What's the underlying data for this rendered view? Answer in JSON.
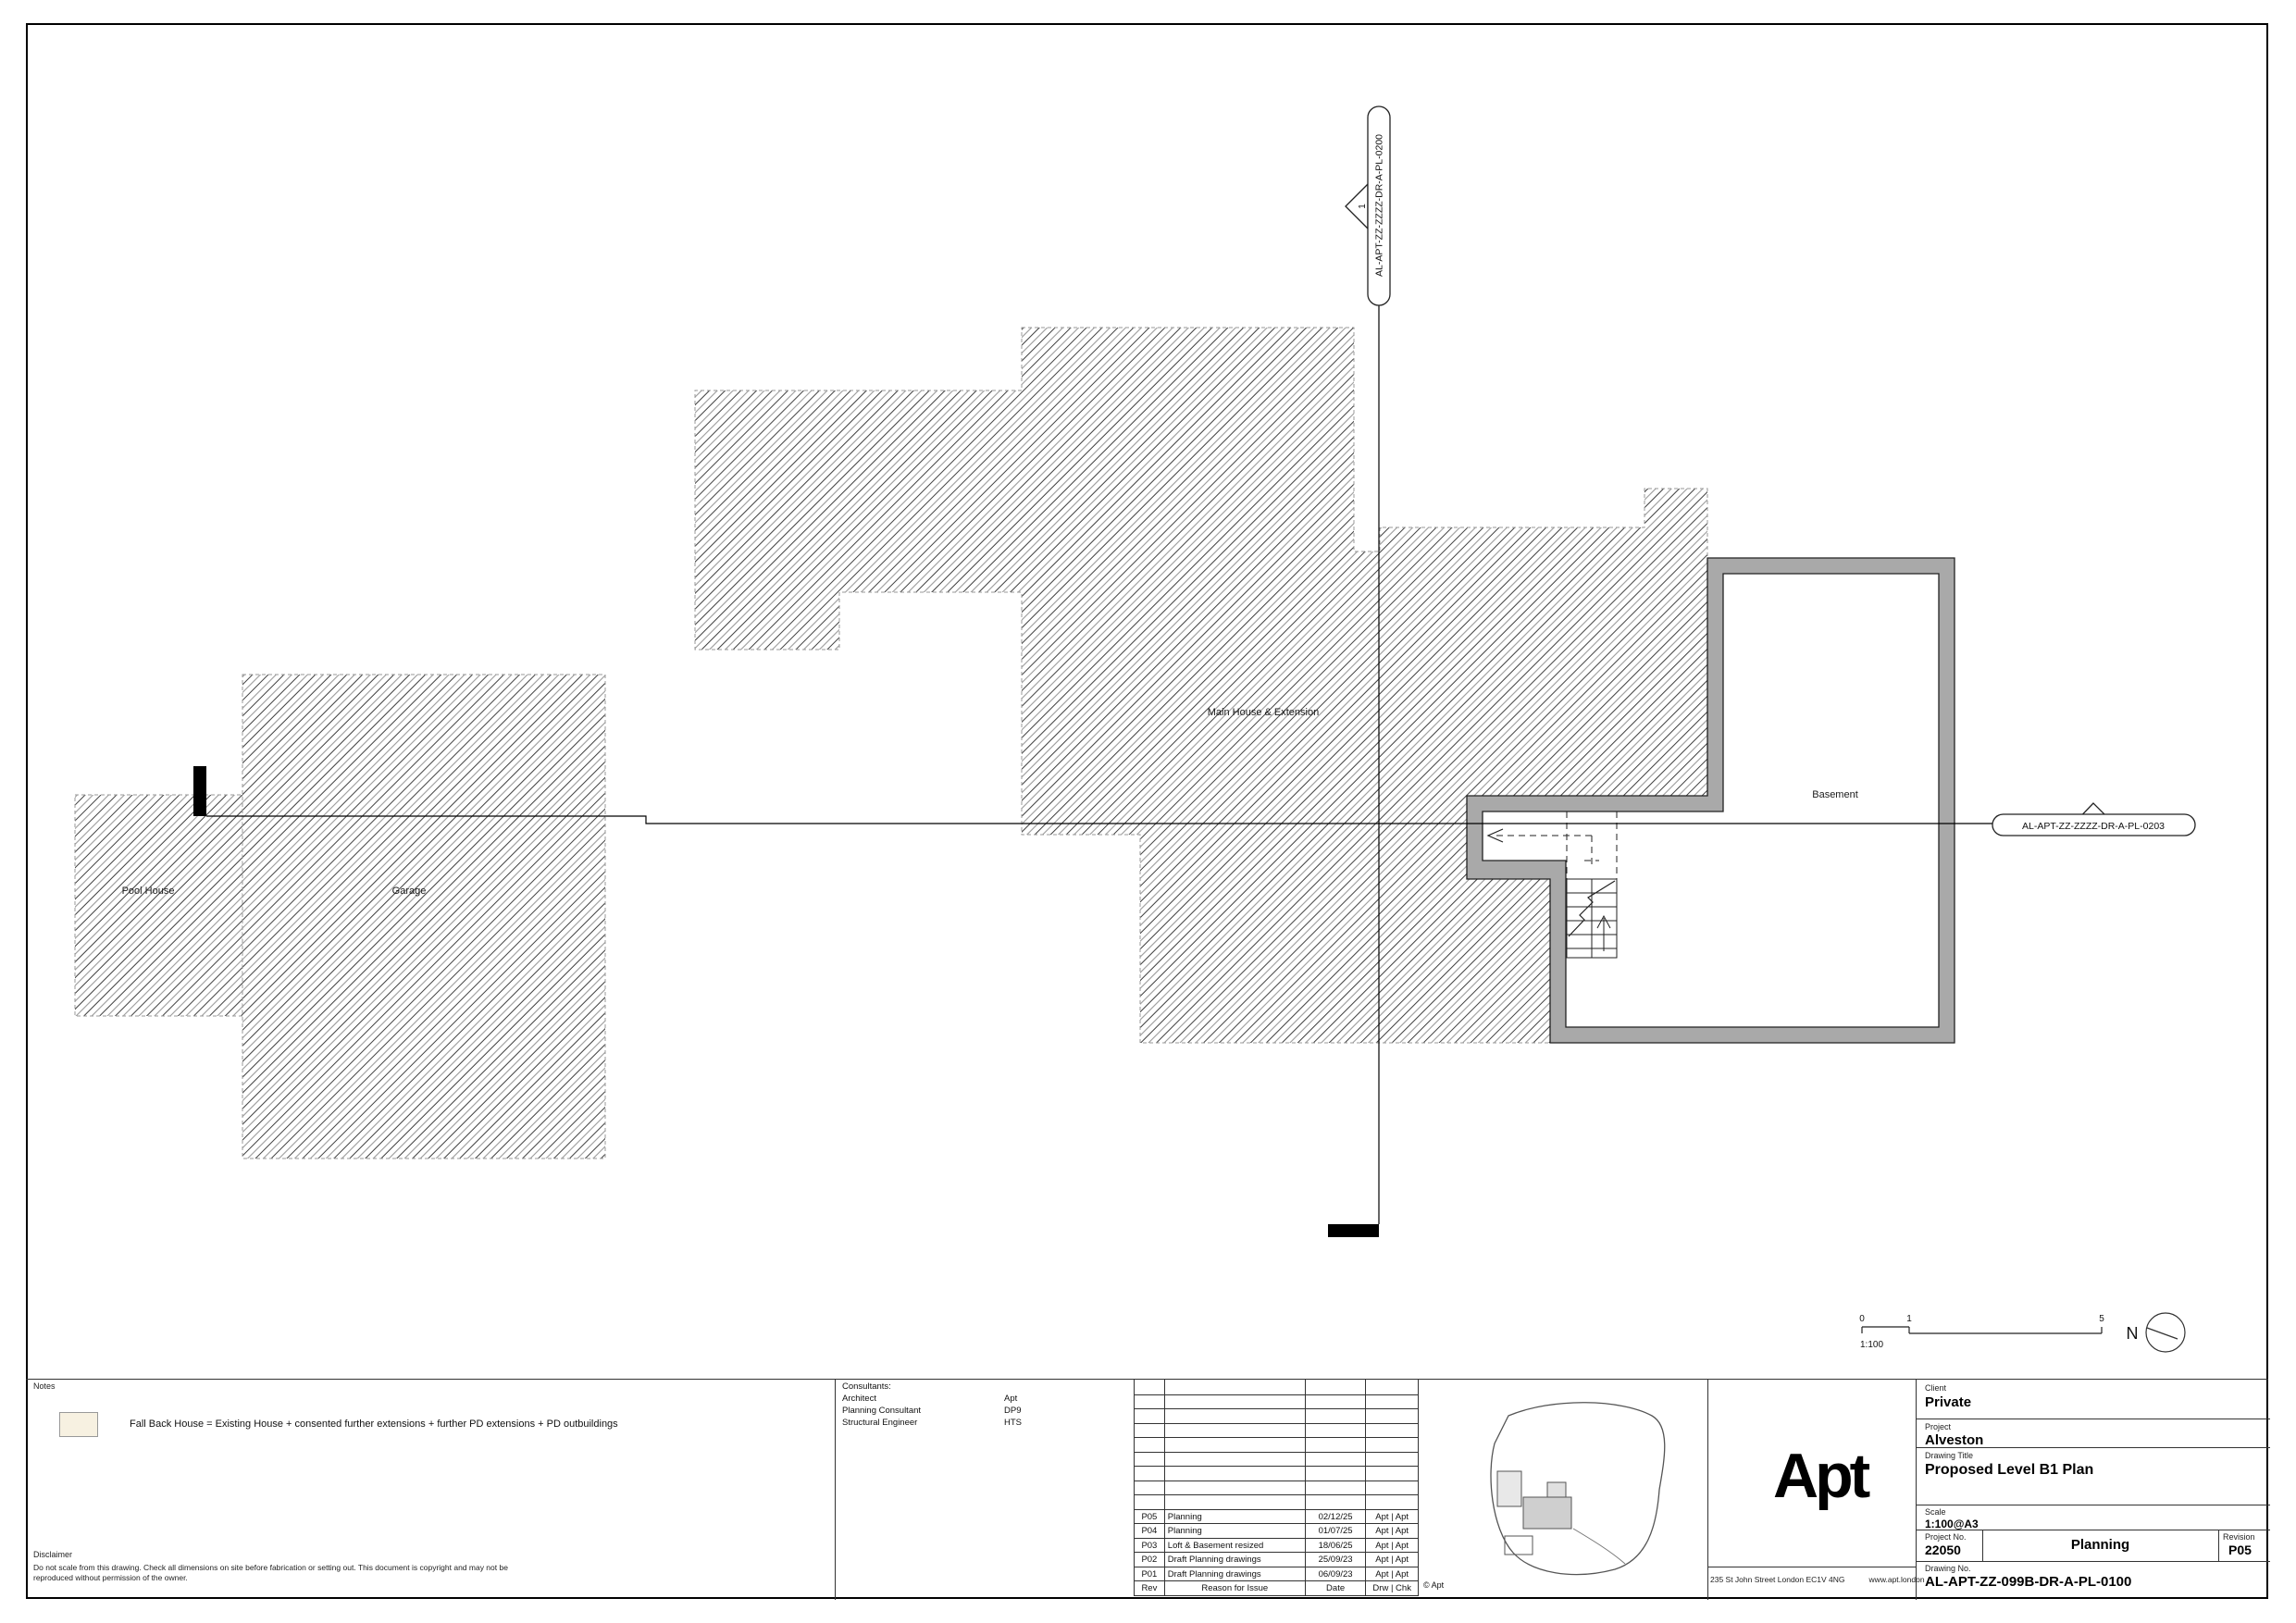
{
  "plan": {
    "labels": {
      "pool_house": "Pool House",
      "garage": "Garage",
      "main_house": "Main House & Extension",
      "basement": "Basement"
    },
    "section_markers": {
      "top": {
        "ref": "AL-APT-ZZ-ZZZZ-DR-A-PL-0200",
        "num": "1"
      },
      "right": {
        "ref": "AL-APT-ZZ-ZZZZ-DR-A-PL-0203",
        "num": "1"
      }
    },
    "scalebar": {
      "tick0": "0",
      "tick1": "1",
      "tick5": "5",
      "ratio": "1:100"
    },
    "north_label": "N",
    "colors": {
      "hatch_dark": "#3f3f3f",
      "hatch_light": "#9b9b9b",
      "wall_gray": "#a9a9a9",
      "legend_swatch": "#f7f1e1"
    }
  },
  "notes": {
    "title": "Notes",
    "legend_text": "Fall Back House = Existing House + consented further extensions + further PD extensions + PD outbuildings"
  },
  "disclaimer": {
    "title": "Disclaimer",
    "text": "Do not scale from this drawing. Check all dimensions on site before fabrication or setting out. This document is copyright and may not be reproduced without permission of the owner."
  },
  "consultants": {
    "title": "Consultants:",
    "rows": [
      {
        "role": "Architect",
        "name": "Apt"
      },
      {
        "role": "Planning Consultant",
        "name": "DP9"
      },
      {
        "role": "Structural Engineer",
        "name": "HTS"
      }
    ]
  },
  "revisions": {
    "header": {
      "rev": "Rev",
      "reason": "Reason for Issue",
      "date": "Date",
      "drwchk": "Drw | Chk"
    },
    "rows": [
      {
        "rev": "P05",
        "reason": "Planning",
        "date": "02/12/25",
        "drwchk": "Apt | Apt"
      },
      {
        "rev": "P04",
        "reason": "Planning",
        "date": "01/07/25",
        "drwchk": "Apt | Apt"
      },
      {
        "rev": "P03",
        "reason": "Loft & Basement resized",
        "date": "18/06/25",
        "drwchk": "Apt | Apt"
      },
      {
        "rev": "P02",
        "reason": "Draft Planning drawings",
        "date": "25/09/23",
        "drwchk": "Apt | Apt"
      },
      {
        "rev": "P01",
        "reason": "Draft Planning drawings",
        "date": "06/09/23",
        "drwchk": "Apt | Apt"
      }
    ],
    "copyright": "© Apt"
  },
  "titleblock": {
    "client_label": "Client",
    "client": "Private",
    "project_label": "Project",
    "project": "Alveston",
    "drawing_title_label": "Drawing Title",
    "drawing_title": "Proposed Level B1 Plan",
    "scale_label": "Scale",
    "scale": "1:100@A3",
    "project_no_label": "Project No.",
    "project_no": "22050",
    "status": "Planning",
    "revision_label": "Revision",
    "revision": "P05",
    "drawing_no_label": "Drawing No.",
    "drawing_no": "AL-APT-ZZ-099B-DR-A-PL-0100"
  },
  "brand": {
    "logo": "Apt",
    "address": "235 St John Street London EC1V 4NG",
    "website": "www.apt.london"
  }
}
